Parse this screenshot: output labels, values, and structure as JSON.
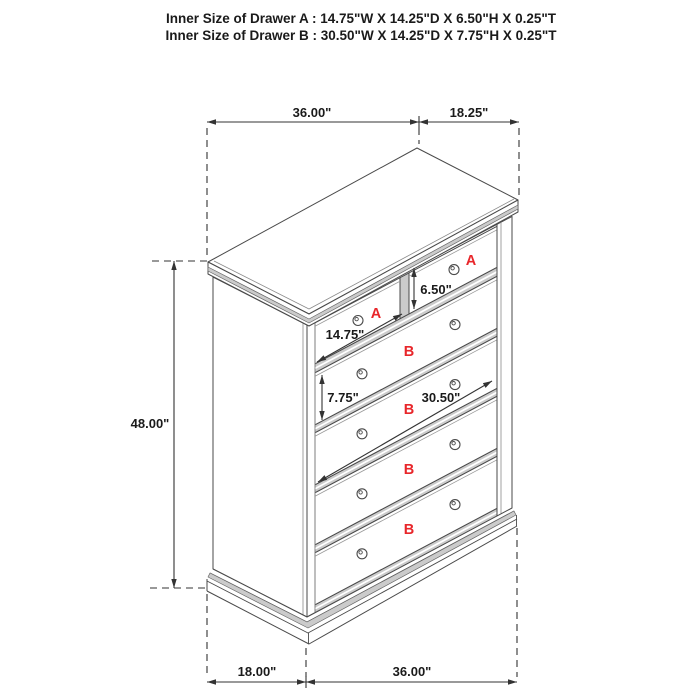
{
  "header": {
    "line1": "Inner Size of Drawer A : 14.75\"W X 14.25\"D X 6.50\"H X 0.25\"T",
    "line2": "Inner Size of Drawer B : 30.50\"W X 14.25\"D X 7.75\"H X 0.25\"T"
  },
  "figure": {
    "type": "furniture-dimension-diagram",
    "item": "chest of drawers with two small A drawers and four wide B drawers",
    "dimensions": {
      "top_width": "36.00\"",
      "top_depth": "18.25\"",
      "height": "48.00\"",
      "bottom_depth": "18.00\"",
      "bottom_width": "36.00\"",
      "drawer_a_width": "14.75\"",
      "drawer_a_height": "6.50\"",
      "drawer_b_width": "30.50\"",
      "drawer_b_height": "7.75\""
    },
    "drawer_labels": {
      "a1": "A",
      "a2": "A",
      "b1": "B",
      "b2": "B",
      "b3": "B",
      "b4": "B"
    }
  },
  "colors": {
    "background": "#ffffff",
    "line": "#4a4a4a",
    "dim_line": "#333333",
    "rail_gray": "#cbcbcb",
    "label_red": "#e8262a",
    "text": "#1a1a1a"
  }
}
